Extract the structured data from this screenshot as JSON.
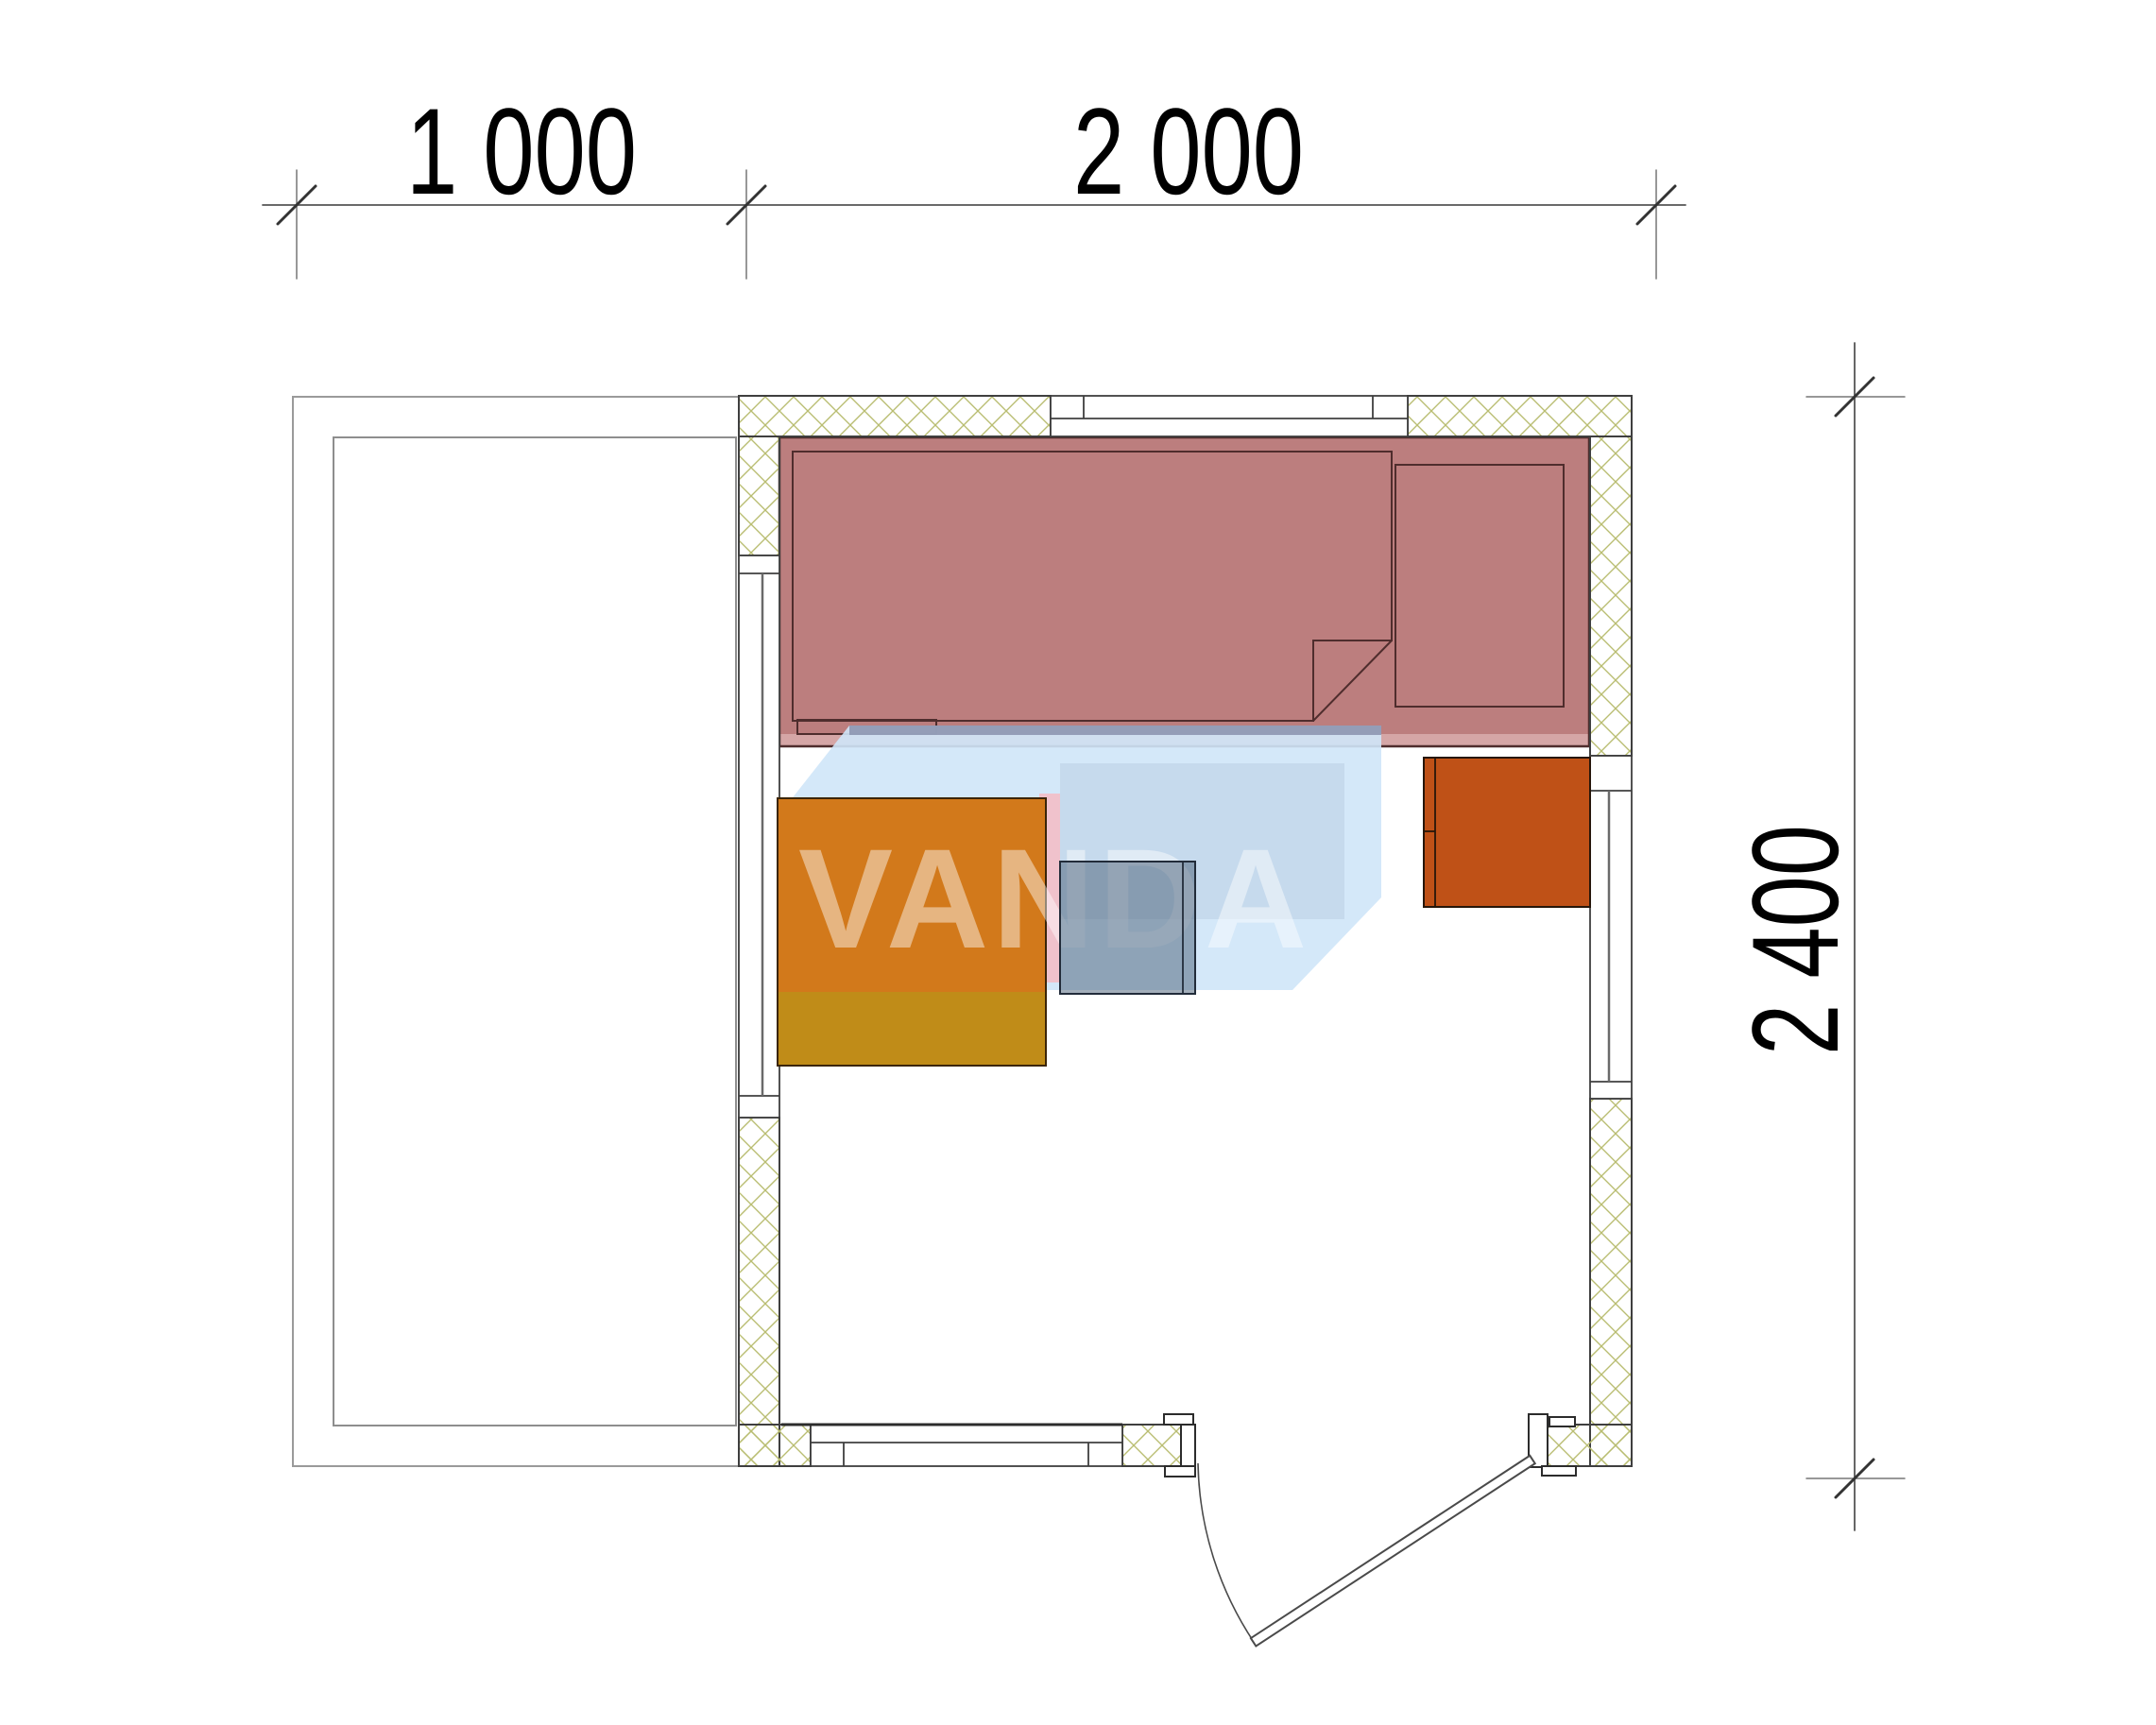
{
  "dimensions": {
    "top": {
      "segments": [
        {
          "label": "1 000"
        },
        {
          "label": "2 000"
        }
      ]
    },
    "right": {
      "label": "2 400"
    }
  },
  "watermark": {
    "text": "VANDA"
  },
  "colors": {
    "bed": "#bc7e7e",
    "bed_edge": "#d5a6a6",
    "bed_outline": "#4f2d2d",
    "table_top": "#d2791b",
    "table_base": "#c08c18",
    "stool": "rgba(72,93,118,0.5)",
    "cabinet": "#bf5117",
    "hatch": "#b9bd72",
    "wall_line": "#3f3f3f",
    "watermark_blue": "#cfe6f8",
    "watermark_pink": "#f5bbc4",
    "watermark_top": "#8a92ae",
    "watermark_inner": "rgba(120,140,170,0.15)",
    "terrace_line": "#9a9a9a",
    "dim_line": "#555555"
  }
}
